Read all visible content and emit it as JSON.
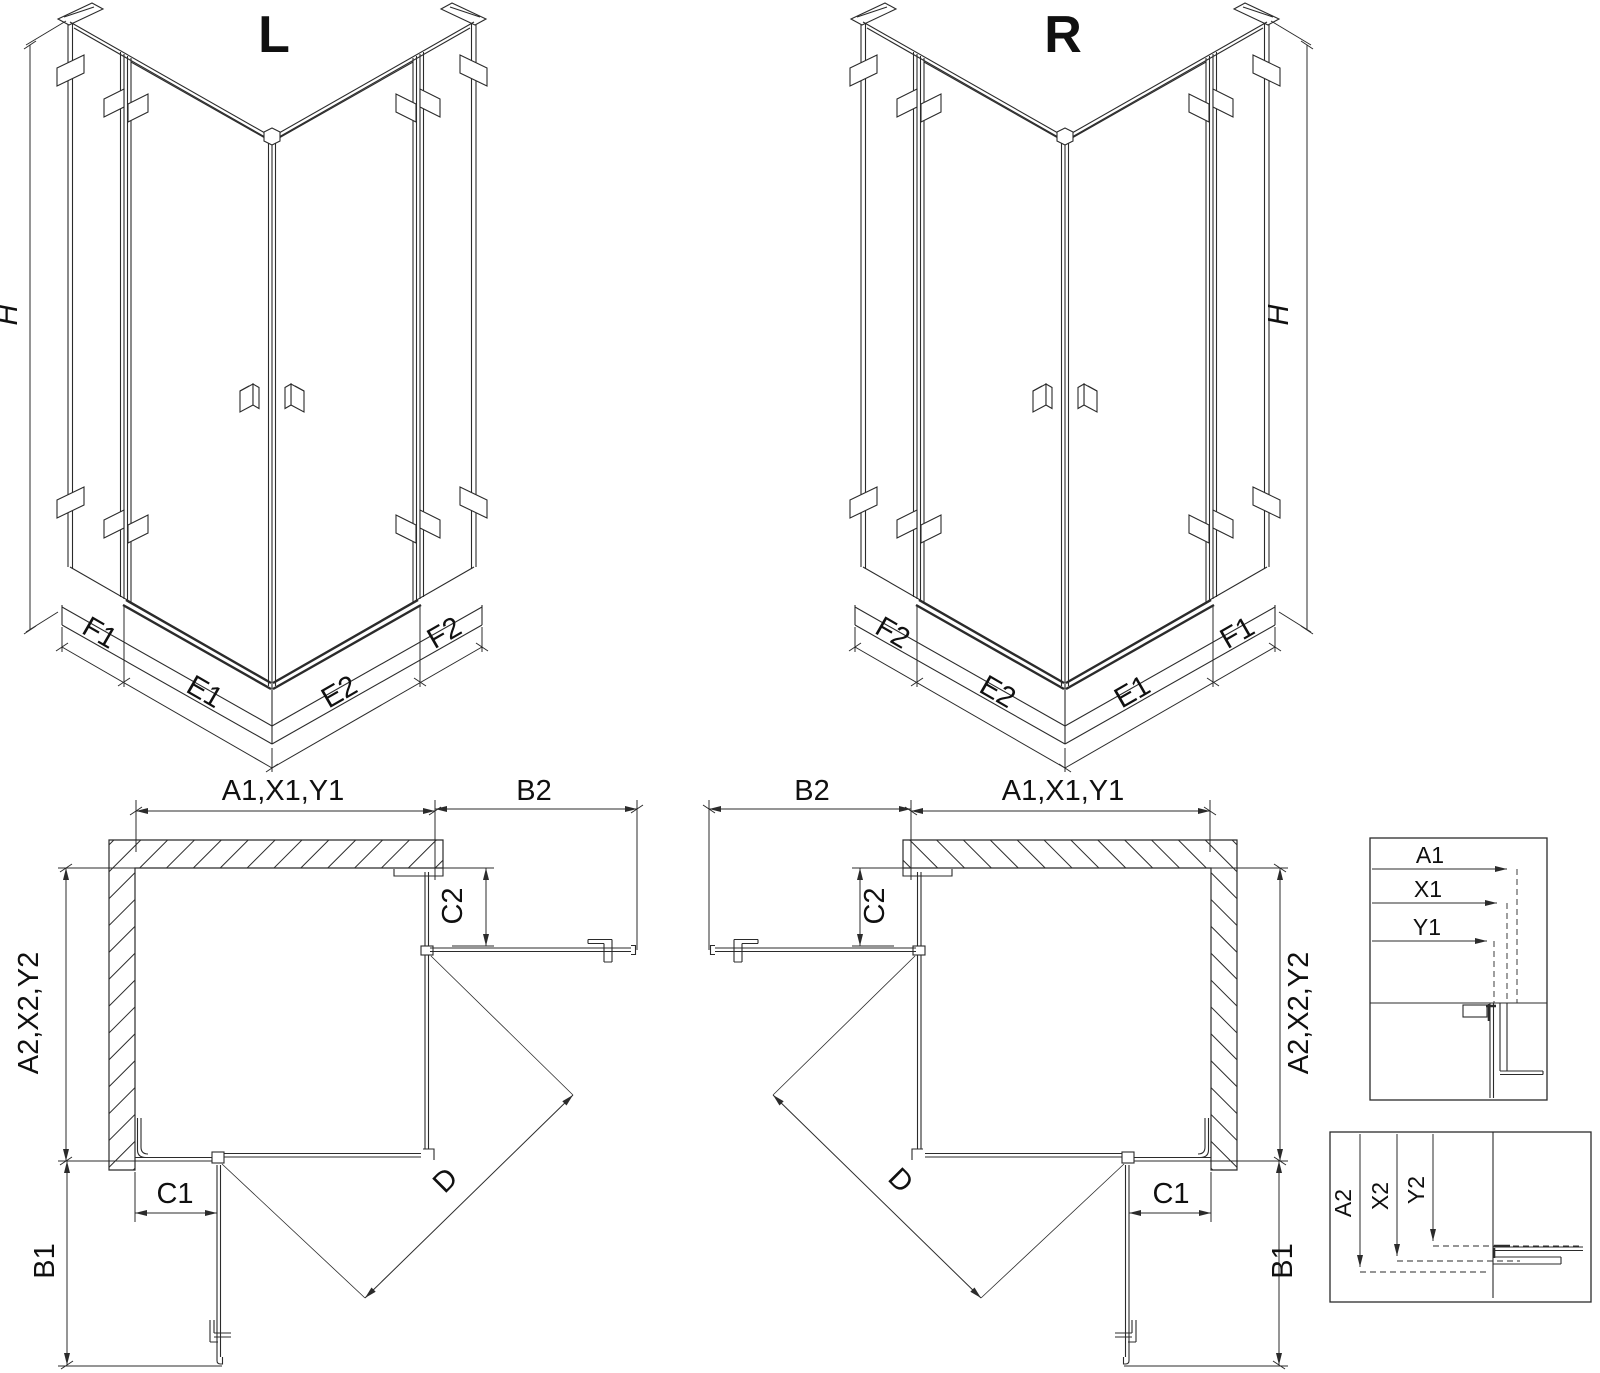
{
  "page": {
    "background": "#ffffff",
    "line_color": "#2b2b2b",
    "text_color": "#101010"
  },
  "iso_left": {
    "title": "L",
    "h": "H",
    "f1": "F1",
    "e1": "E1",
    "e2": "E2",
    "f2": "F2"
  },
  "iso_right": {
    "title": "R",
    "h": "H",
    "f1": "F1",
    "e1": "E1",
    "e2": "E2",
    "f2": "F2"
  },
  "plan_left": {
    "a1": "A1,X1,Y1",
    "b2": "B2",
    "c2": "C2",
    "a2": "A2,X2,Y2",
    "b1": "B1",
    "c1": "C1",
    "d": "D"
  },
  "plan_right": {
    "a1": "A1,X1,Y1",
    "b2": "B2",
    "c2": "C2",
    "a2": "A2,X2,Y2",
    "b1": "B1",
    "c1": "C1",
    "d": "D"
  },
  "detail_top": {
    "a1": "A1",
    "x1": "X1",
    "y1": "Y1"
  },
  "detail_bottom": {
    "a2": "A2",
    "x2": "X2",
    "y2": "Y2"
  }
}
